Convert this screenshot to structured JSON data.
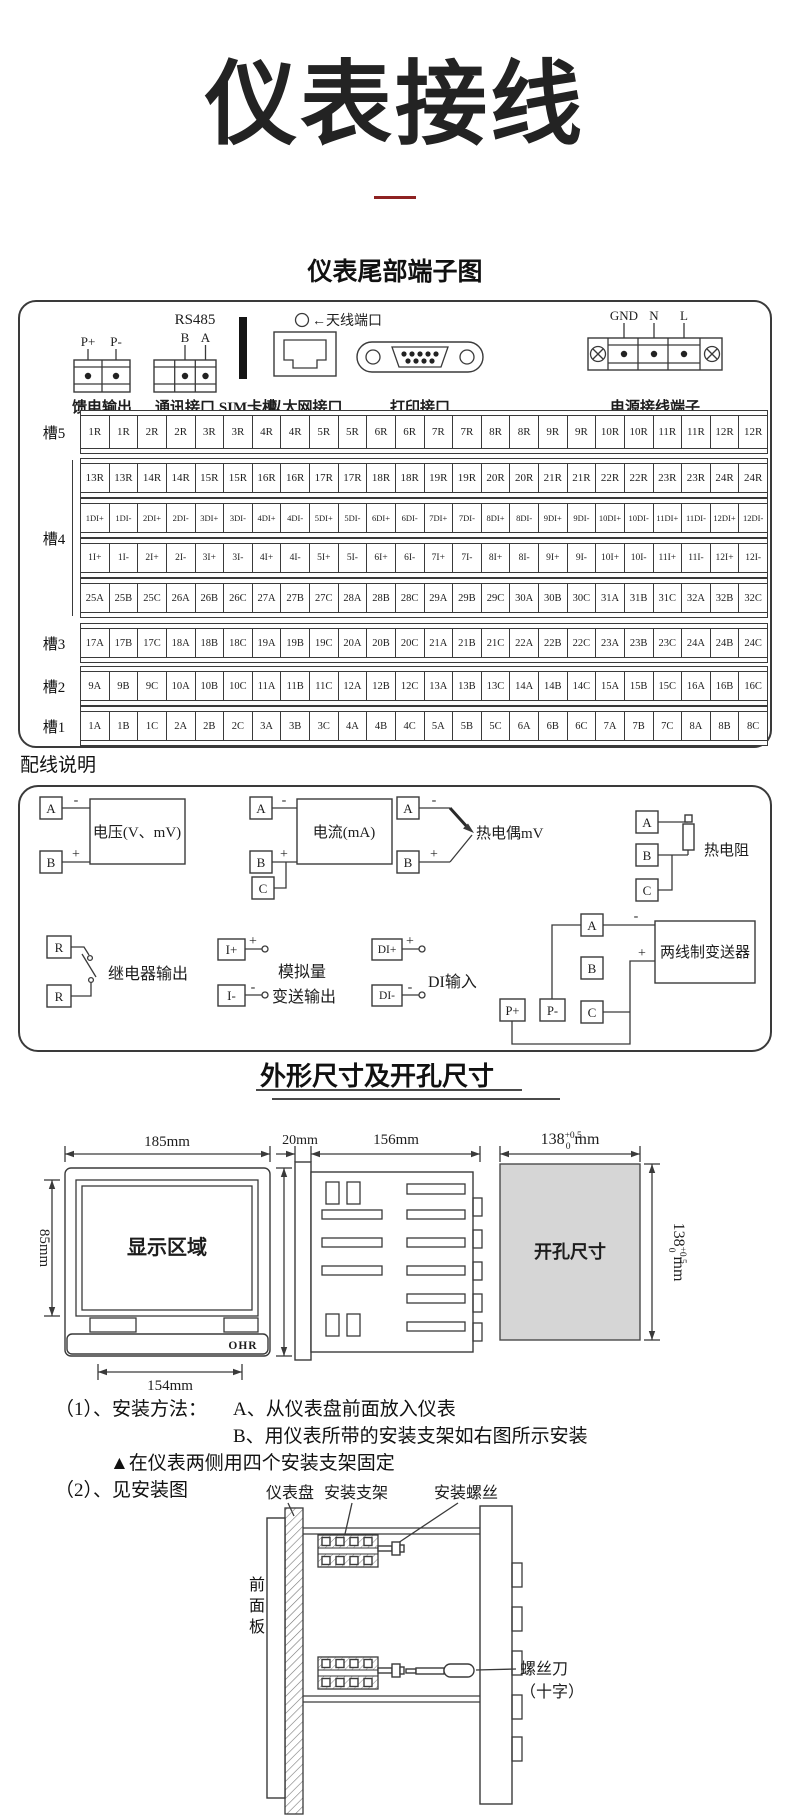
{
  "page": {
    "title": "仪表接线",
    "subtitle": "仪表尾部端子图",
    "accent_color": "#8e2222"
  },
  "rear": {
    "connectors": {
      "feed": {
        "pin1": "P+",
        "pin2": "P-",
        "label": "馈电输出"
      },
      "comm": {
        "bus": "RS485",
        "pin1": "B",
        "pin2": "A",
        "label": "通讯接口"
      },
      "sim": {
        "label": "SIM卡槽"
      },
      "eth": {
        "antenna": "←天线端口",
        "label": "以太网接口"
      },
      "printer": {
        "label": "打印接口"
      },
      "power": {
        "pin1": "GND",
        "pin2": "N",
        "pin3": "L",
        "label": "电源接线端子"
      }
    },
    "slots": [
      {
        "name": "槽5",
        "rows": [
          [
            "1R",
            "1R",
            "2R",
            "2R",
            "3R",
            "3R",
            "4R",
            "4R",
            "5R",
            "5R",
            "6R",
            "6R",
            "7R",
            "7R",
            "8R",
            "8R",
            "9R",
            "9R",
            "10R",
            "10R",
            "11R",
            "11R",
            "12R",
            "12R"
          ]
        ]
      },
      {
        "name": "槽4",
        "rows": [
          [
            "13R",
            "13R",
            "14R",
            "14R",
            "15R",
            "15R",
            "16R",
            "16R",
            "17R",
            "17R",
            "18R",
            "18R",
            "19R",
            "19R",
            "20R",
            "20R",
            "21R",
            "21R",
            "22R",
            "22R",
            "23R",
            "23R",
            "24R",
            "24R"
          ],
          [
            "1DI+",
            "1DI-",
            "2DI+",
            "2DI-",
            "3DI+",
            "3DI-",
            "4DI+",
            "4DI-",
            "5DI+",
            "5DI-",
            "6DI+",
            "6DI-",
            "7DI+",
            "7DI-",
            "8DI+",
            "8DI-",
            "9DI+",
            "9DI-",
            "10DI+",
            "10DI-",
            "11DI+",
            "11DI-",
            "12DI+",
            "12DI-"
          ],
          [
            "1I+",
            "1I-",
            "2I+",
            "2I-",
            "3I+",
            "3I-",
            "4I+",
            "4I-",
            "5I+",
            "5I-",
            "6I+",
            "6I-",
            "7I+",
            "7I-",
            "8I+",
            "8I-",
            "9I+",
            "9I-",
            "10I+",
            "10I-",
            "11I+",
            "11I-",
            "12I+",
            "12I-"
          ],
          [
            "25A",
            "25B",
            "25C",
            "26A",
            "26B",
            "26C",
            "27A",
            "27B",
            "27C",
            "28A",
            "28B",
            "28C",
            "29A",
            "29B",
            "29C",
            "30A",
            "30B",
            "30C",
            "31A",
            "31B",
            "31C",
            "32A",
            "32B",
            "32C"
          ]
        ]
      },
      {
        "name": "槽3",
        "rows": [
          [
            "17A",
            "17B",
            "17C",
            "18A",
            "18B",
            "18C",
            "19A",
            "19B",
            "19C",
            "20A",
            "20B",
            "20C",
            "21A",
            "21B",
            "21C",
            "22A",
            "22B",
            "22C",
            "23A",
            "23B",
            "23C",
            "24A",
            "24B",
            "24C"
          ]
        ]
      },
      {
        "name": "槽2",
        "rows": [
          [
            "9A",
            "9B",
            "9C",
            "10A",
            "10B",
            "10C",
            "11A",
            "11B",
            "11C",
            "12A",
            "12B",
            "12C",
            "13A",
            "13B",
            "13C",
            "14A",
            "14B",
            "14C",
            "15A",
            "15B",
            "15C",
            "16A",
            "16B",
            "16C"
          ]
        ]
      },
      {
        "name": "槽1",
        "rows": [
          [
            "1A",
            "1B",
            "1C",
            "2A",
            "2B",
            "2C",
            "3A",
            "3B",
            "3C",
            "4A",
            "4B",
            "4C",
            "5A",
            "5B",
            "5C",
            "6A",
            "6B",
            "6C",
            "7A",
            "7B",
            "7C",
            "8A",
            "8B",
            "8C"
          ]
        ]
      }
    ]
  },
  "wiring": {
    "heading": "配线说明",
    "v": {
      "a": "A",
      "b": "B",
      "minus": "-",
      "plus": "+",
      "label": "电压(V、mV)"
    },
    "i": {
      "a": "A",
      "b": "B",
      "c": "C",
      "minus": "-",
      "plus": "+",
      "label": "电流(mA)"
    },
    "tc": {
      "a": "A",
      "b": "B",
      "minus": "-",
      "plus": "+",
      "label": "热电偶mV"
    },
    "rtd": {
      "a": "A",
      "b": "B",
      "c": "C",
      "label": "热电阻"
    },
    "relay": {
      "p1": "R",
      "p2": "R",
      "label": "继电器输出"
    },
    "ao": {
      "p1": "I+",
      "p2": "I-",
      "plus": "+",
      "minus": "-",
      "label1": "模拟量",
      "label2": "变送输出"
    },
    "di": {
      "p1": "DI+",
      "p2": "DI-",
      "plus": "+",
      "minus": "-",
      "label": "DI输入"
    },
    "tx": {
      "a": "A",
      "b": "B",
      "c": "C",
      "p1": "P+",
      "p2": "P-",
      "plus": "+",
      "minus": "-",
      "label": "两线制变送器"
    }
  },
  "dims": {
    "heading": "外形尺寸及开孔尺寸",
    "front": {
      "top": "185mm",
      "left": "85mm",
      "right": "154mm",
      "bottom": "154mm",
      "display": "显示区域",
      "logo": "OHR"
    },
    "side": {
      "d1": "20mm",
      "d2": "156mm"
    },
    "cutout": {
      "label": "开孔尺寸",
      "base": "138",
      "sup": "+0.5",
      "sub": "0",
      "unit": "mm"
    }
  },
  "install": {
    "l1a": "（1）、安装方法：",
    "l1b": "A、从仪表盘前面放入仪表",
    "l2": "B、用仪表所带的安装支架如右图所示安装",
    "l3": "▲在仪表两侧用四个安装支架固定",
    "l4": "（2）、见安装图",
    "labels": {
      "panel": "仪表盘",
      "bracket": "安装支架",
      "screw": "安装螺丝",
      "front_panel": "前面板",
      "driver1": "螺丝刀",
      "driver2": "（十字）"
    }
  }
}
